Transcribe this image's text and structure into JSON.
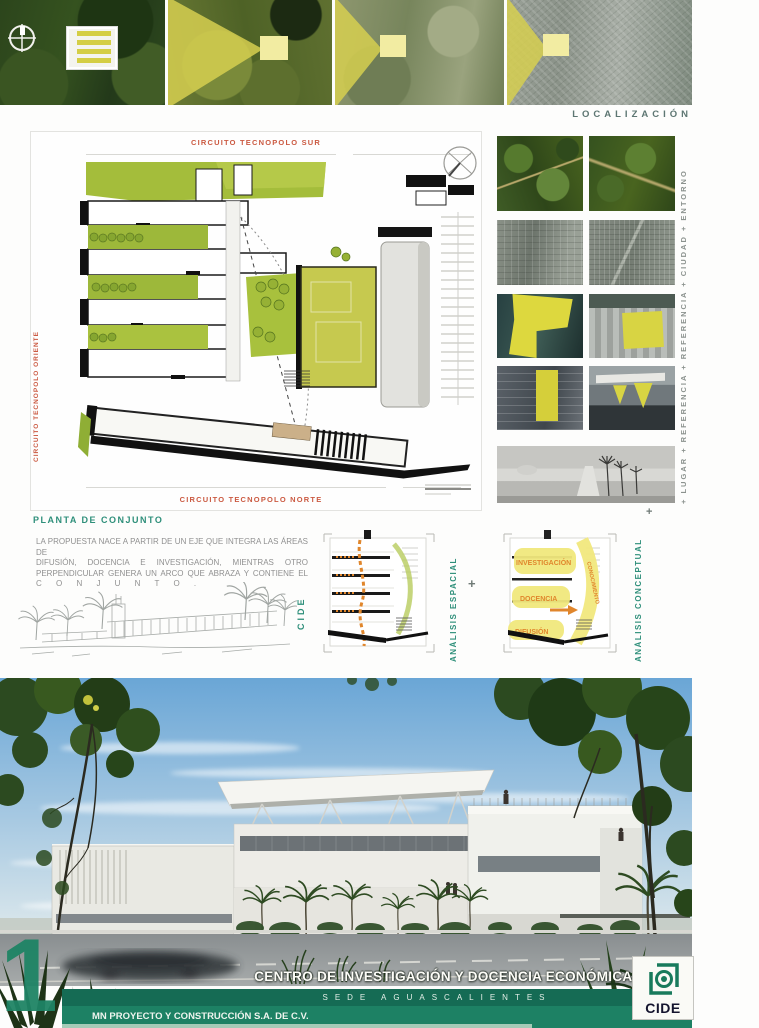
{
  "strip": {
    "localizacion": "LOCALIZACIÓN"
  },
  "plan": {
    "street_top": "CIRCUITO TECNOPOLO SUR",
    "street_left": "CIRCUITO TECNOPOLO ORIENTE",
    "street_bottom": "CIRCUITO TECNOPOLO NORTE",
    "caption": "PLANTA DE CONJUNTO"
  },
  "intro": {
    "lines": [
      "LA PROPUESTA NACE A PARTIR DE UN EJE QUE INTEGRA LAS ÁREAS DE",
      "DIFUSIÓN, DOCENCIA E INVESTIGACIÓN, MIENTRAS OTRO",
      "PERPENDICULAR GENERA UN ARCO QUE ABRAZA Y CONTIENE EL",
      "C O N J U N T O ."
    ]
  },
  "analysis": {
    "cide": "CIDE",
    "spatial": "ANÁLISIS ESPACIAL",
    "conceptual": "ANÁLISIS CONCEPTUAL",
    "plus": "+",
    "zones": [
      "INVESTIGACIÓN",
      "DOCENCIA",
      "DIFUSIÓN"
    ],
    "arc": "CONOCIMIENTO"
  },
  "photos": {
    "caption": "+ LUGAR + REFERENCIA + REFERENCIA + CIUDAD + ENTORNO"
  },
  "footer": {
    "number": "1",
    "title": "CENTRO DE INVESTIGACIÓN Y DOCENCIA ECONÓMICAS",
    "sede": "SEDE AGUASCALIENTES",
    "firm": "MN PROYECTO Y CONSTRUCCIÓN S.A. DE C.V.",
    "logo": "CIDE"
  },
  "colors": {
    "accent_teal": "#2e8f7a",
    "street_red": "#cb5a42",
    "highlight_yellow": "#ddd83e",
    "band_green": "#156b54",
    "plan_green": "#a4bd3b"
  }
}
